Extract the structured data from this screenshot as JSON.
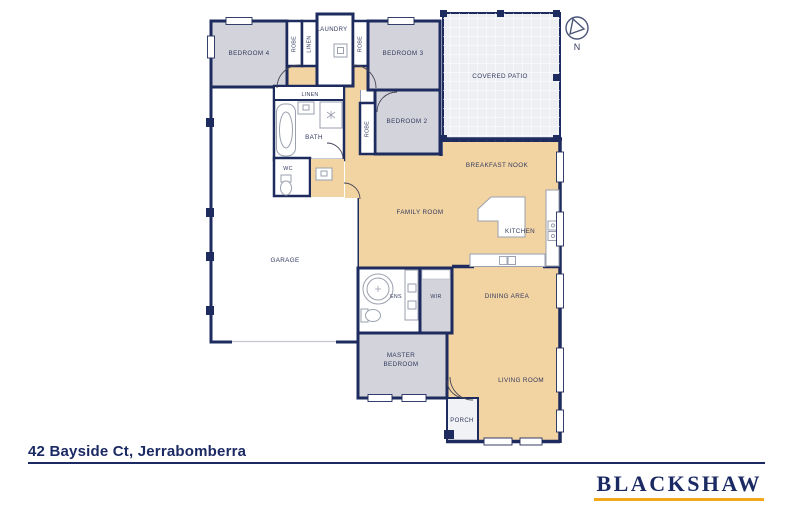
{
  "plan": {
    "rooms": {
      "bedroom4": "BEDROOM 4",
      "bedroom3": "BEDROOM 3",
      "bedroom2": "BEDROOM 2",
      "master_bedroom_line1": "MASTER",
      "master_bedroom_line2": "BEDROOM",
      "garage": "GARAGE",
      "family_room": "FAMILY ROOM",
      "breakfast_nook": "BREAKFAST NOOK",
      "kitchen": "KITCHEN",
      "dining_area": "DINING AREA",
      "living_room": "LIVING ROOM",
      "covered_patio": "COVERED PATIO",
      "laundry": "LAUNDRY",
      "bath": "BATH",
      "wc": "WC",
      "ens": "ENS",
      "wir": "WIR",
      "porch": "PORCH",
      "linen_top": "LINEN",
      "linen_hall": "LINEN",
      "robe_bedroom4": "ROBE",
      "robe_bedroom3": "ROBE",
      "robe_bedroom2": "ROBE"
    },
    "compass": {
      "north_label": "N"
    }
  },
  "footer": {
    "address": "42 Bayside Ct, Jerrabomberra",
    "brand": "BLACKSHAW"
  },
  "colors": {
    "wall_navy": "#1e2b5e",
    "bedroom_gray": "#d3d4db",
    "living_tan": "#f2d3a2",
    "patio_gray": "#edeff2",
    "brand_navy": "#1b2a63",
    "brand_gold": "#f3a81b"
  }
}
